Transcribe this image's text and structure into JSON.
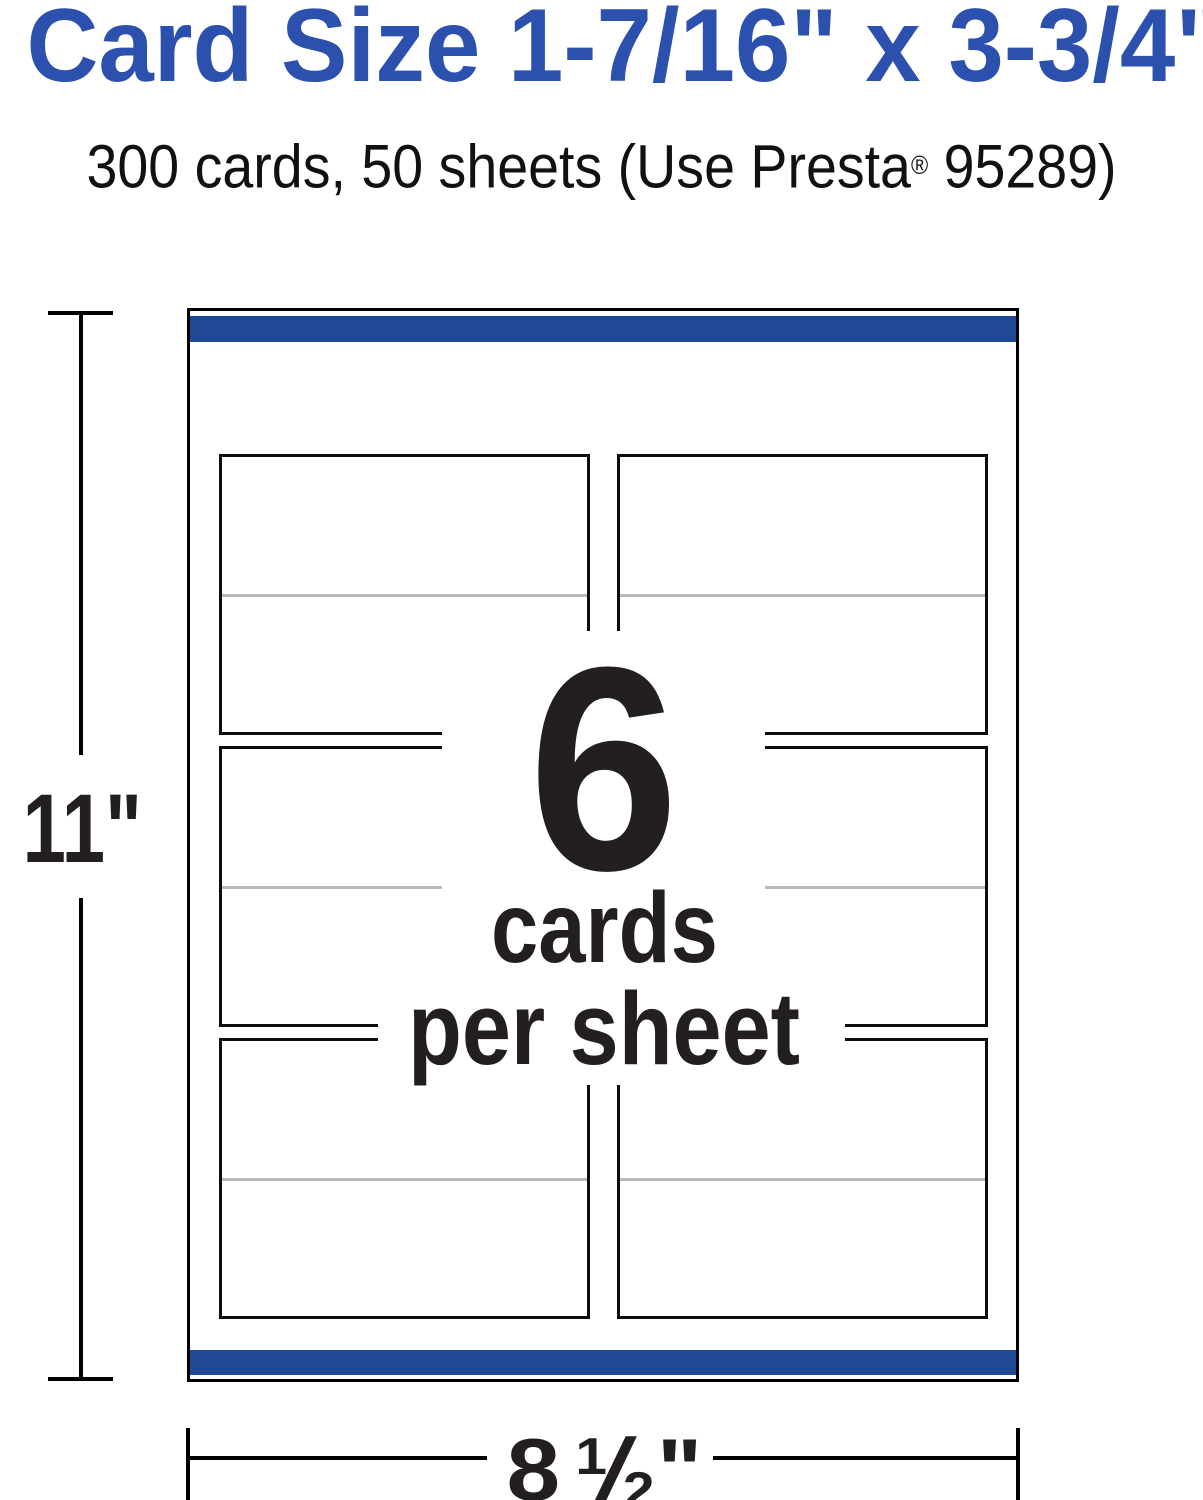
{
  "page": {
    "title": "Card Size 1-7/16\" x 3-3/4\"",
    "subtitle": {
      "before_reg": "300 cards, 50 sheets (Use Presta",
      "reg_mark": "®",
      "after_reg": " 95289)"
    }
  },
  "diagram": {
    "center": {
      "count": "6",
      "line1": "cards",
      "line2": "per sheet"
    },
    "grid": {
      "rows": 3,
      "columns": 2,
      "card_count": 6
    },
    "dimensions": {
      "height_label": "11\"",
      "width_whole": "8",
      "width_frac_numerator": "1",
      "width_frac_slash": "/",
      "width_frac_denominator": "2",
      "width_unit": "\""
    }
  },
  "colors": {
    "title_blue": "#2b50ae",
    "bar_blue": "#1f4897",
    "fold_line_gray": "#b9b9b9",
    "ink_black": "#231f20"
  }
}
